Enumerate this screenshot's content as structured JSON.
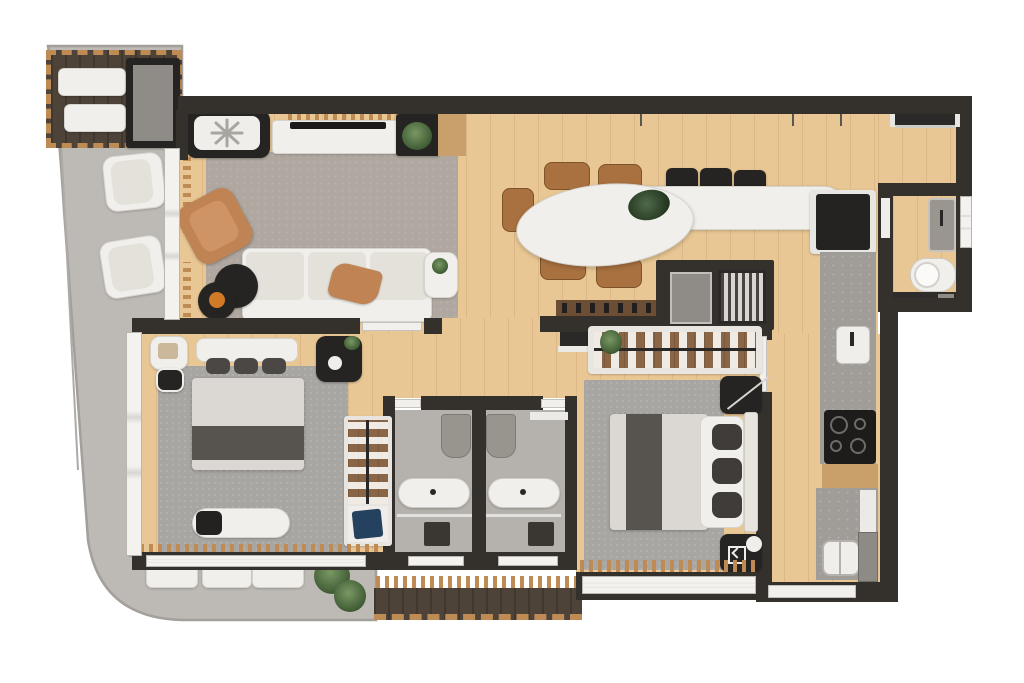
{
  "colors": {
    "wall": "#34312d",
    "wood": "#e9c794",
    "slab": "#bdb9b5",
    "slabEdge": "#a39f9b",
    "deck": "#4e4339",
    "deckEdge": "#bf8b55",
    "rugLiving": "#b0a8a0",
    "rugBed": "#a8a6a2",
    "white": "#f1efeb",
    "softWhite": "#e4e1db",
    "black": "#262422",
    "leather": "#bf8354",
    "chairWood": "#a8713f",
    "closetWood": "#8a6647",
    "stone": "#a09c97",
    "bathFloor": "#b5b1ac",
    "plantGreen": "#42603a",
    "accentBlue": "#24425f",
    "trayOrange": "#d07a28"
  },
  "scene": {
    "type": "apartment-floor-plan-3d-render",
    "rooms": [
      "terrace",
      "top-deck",
      "living-room",
      "dining-area",
      "kitchen",
      "powder-room",
      "hallway",
      "bedroom-left",
      "bedroom-right",
      "bathroom-left",
      "bathroom-right",
      "laundry-corner",
      "barbecue-nook",
      "bottom-deck"
    ],
    "furniture_counts": {
      "sun_loungers": 2,
      "terrace_armchairs": 2,
      "terrace_chairs": 3,
      "dining_chairs": 5,
      "bar_stools": 3,
      "sofa_seats": 3,
      "beds": 2,
      "toilets": 3,
      "vanities": 3,
      "showers": 2,
      "cooktop_burners": 4,
      "potted_plants": 5
    }
  }
}
